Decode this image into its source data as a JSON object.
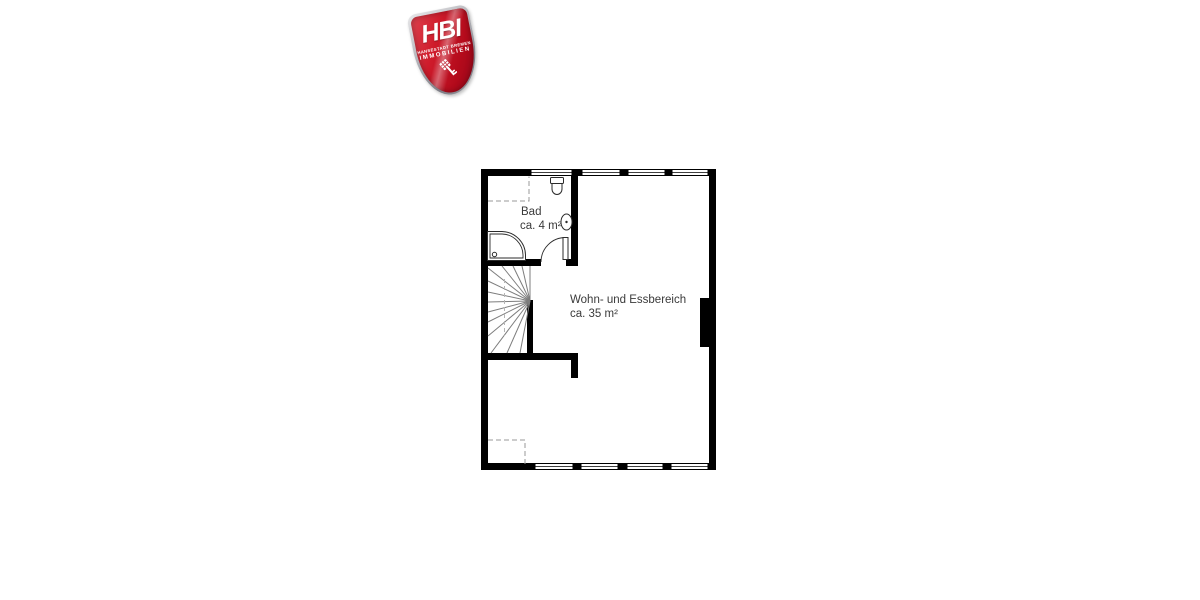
{
  "logo": {
    "acronym": "HBI",
    "subtitle_line1": "HANSESTADT BREMEN",
    "subtitle_line2": "IMMOBILIEN",
    "icon": "bremen-key-icon",
    "colors": {
      "shield_red": "#c6101f",
      "shield_red_dark": "#93061a",
      "rim_silver": "#b9b9be",
      "text": "#ffffff"
    }
  },
  "floorplan": {
    "rooms": [
      {
        "name": "Bad",
        "area": "ca. 4 m²"
      },
      {
        "name": "Wohn- und Essbereich",
        "area": "ca. 35 m²"
      }
    ],
    "colors": {
      "walls": "#000000",
      "fixtures": "#2b2b2b",
      "stairs": "#7d7d7d",
      "text": "#3a3a3a",
      "background": "#ffffff"
    }
  }
}
